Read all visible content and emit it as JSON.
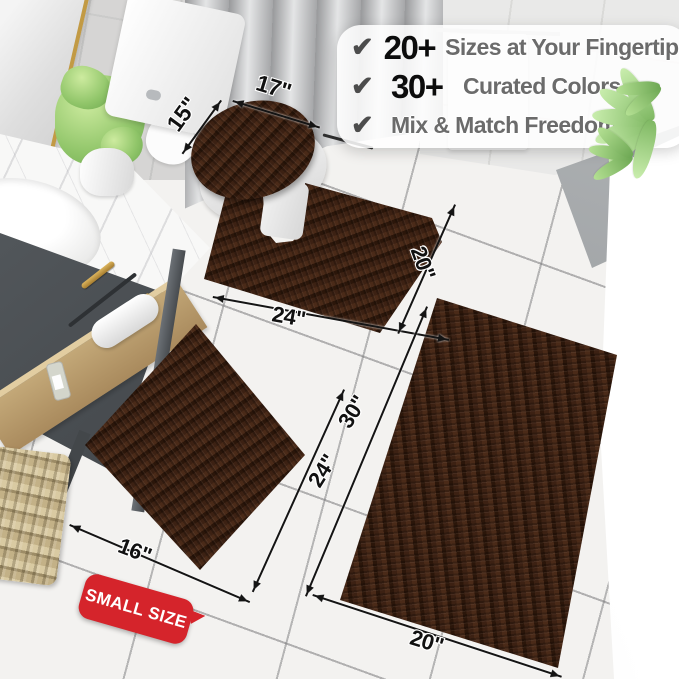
{
  "feature_panel": {
    "check_icon": "✔",
    "items": [
      {
        "stat": "20+",
        "label": "Sizes at Your Fingertips"
      },
      {
        "stat": "30+",
        "label": "Curated Colors"
      },
      {
        "label": "Mix & Match Freedom"
      }
    ]
  },
  "dimension_labels": {
    "lid_width": "17\"",
    "lid_depth": "15\"",
    "contour_width": "24\"",
    "contour_depth": "20\"",
    "large_rug_length": "30\"",
    "small_rug_length": "24\"",
    "small_rug_width": "16\"",
    "large_rug_width": "20\""
  },
  "badge": {
    "label": "SMALL SIZE"
  },
  "colors": {
    "rug_brown": "#3c2113",
    "rug_brown_dark": "#2b160a",
    "rug_brown_light": "#4a2a18",
    "badge_red": "#d5242b",
    "gold": "#c29a44",
    "floor_tile": "#f3f2f0",
    "wall_tile": "#d6d5d4",
    "curtain_gray": "#aaabad",
    "cabinet_gray": "#4c5156",
    "wood": "#c3a878",
    "plant_green": "#9ccf7c",
    "text_dark": "#111111",
    "text_gray": "#6b6b6b",
    "check_gray": "#4c4c4c"
  }
}
